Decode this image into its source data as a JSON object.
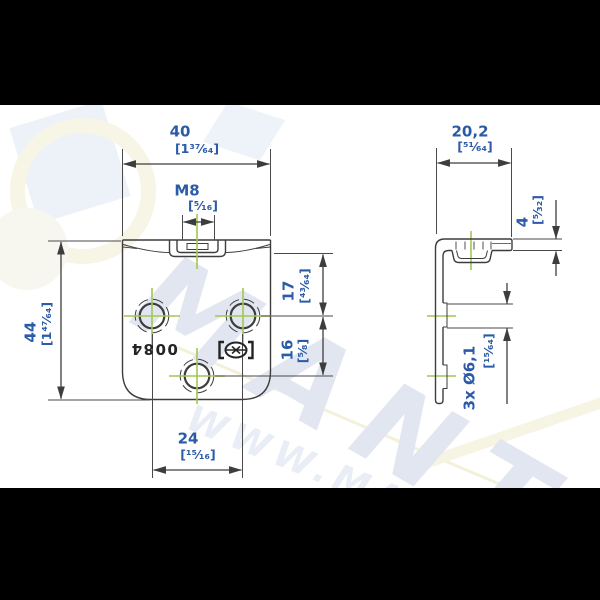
{
  "title": "angle bracket technical drawing",
  "colors": {
    "dim_text": "#2b5aa7",
    "drawing_line": "#3d3d3d",
    "centerline_green": "#a2c653",
    "stamp": "#242424",
    "letterbox": "#000000",
    "background": "#ffffff",
    "watermark_letters": "#e2e6f0"
  },
  "dims": {
    "front_width": {
      "value": "40",
      "frac": "[1³⁷⁄₆₄]"
    },
    "front_thread": {
      "value": "M8",
      "frac": "[⁵⁄₁₆]"
    },
    "front_height": {
      "value": "44",
      "frac": "[1⁴⁷⁄₆₄]"
    },
    "hole_offset_top": {
      "value": "17",
      "frac": "[⁴³⁄₆₄]"
    },
    "hole_pitch_vertical": {
      "value": "16",
      "frac": "[⁵⁄₈]"
    },
    "hole_pitch_horizontal": {
      "value": "24",
      "frac": "[¹⁵⁄₁₆]"
    },
    "side_depth": {
      "value": "20,2",
      "frac": "[⁵¹⁄₆₄]"
    },
    "side_thickness": {
      "value": "4",
      "frac": "[⁵⁄₃₂]"
    },
    "side_holes": {
      "value": "3x Ø6,1",
      "frac": "[¹⁵⁄₆₄]"
    }
  },
  "stamp": {
    "code": "0084"
  },
  "watermark": {
    "big": "MANTI",
    "small": "WWW.MA"
  }
}
